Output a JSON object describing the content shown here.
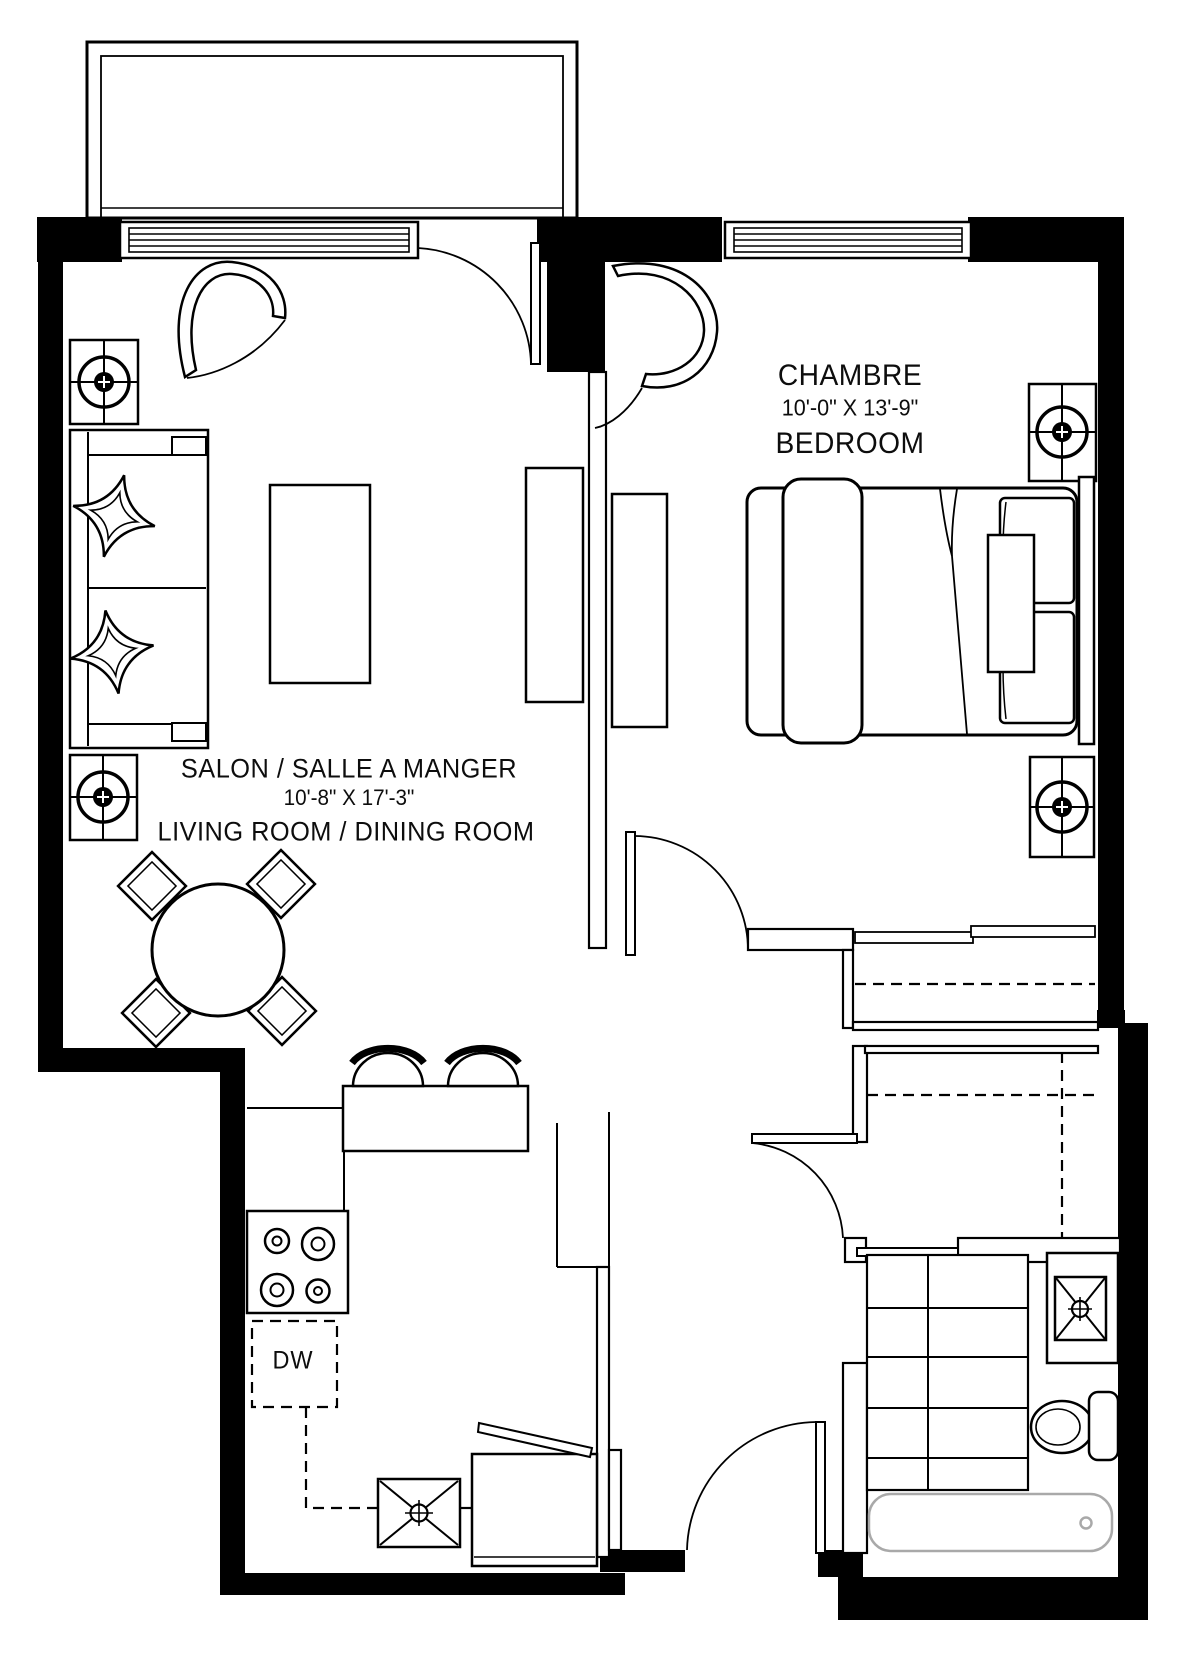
{
  "canvas": {
    "width": 1184,
    "height": 1667,
    "background": "#ffffff",
    "ink": "#000000",
    "tub_ink": "#a9a9a9"
  },
  "labels": {
    "living_dining": {
      "title": "SALON / SALLE A MANGER",
      "dimensions": "10'-8\" X 17'-3\"",
      "subtitle": "LIVING ROOM  / DINING ROOM"
    },
    "bedroom": {
      "title": "CHAMBRE",
      "dimensions": "10'-0\" X 13'-9\"",
      "subtitle": "BEDROOM"
    },
    "kitchen": {
      "dishwasher_label": "DW"
    }
  },
  "fixtures": {
    "living_dining": [
      "sofa",
      "throw-pillow-star",
      "coffee-table",
      "tv-cabinet",
      "round-dining-table",
      "dining-chairs",
      "curtain",
      "column-marker"
    ],
    "bedroom": [
      "double-bed",
      "pillows",
      "headboard",
      "dresser",
      "curtain",
      "sliding-closet",
      "column-marker"
    ],
    "kitchen": [
      "peninsula-counter",
      "bar-stools",
      "cooktop-4-burners",
      "dishwasher",
      "sink-basin",
      "refrigerator"
    ],
    "bathroom": [
      "vanity-sink",
      "toilet",
      "bathtub",
      "tile-floor"
    ],
    "entry": [
      "entry-door",
      "coat-closet",
      "shelf-dashes"
    ]
  }
}
